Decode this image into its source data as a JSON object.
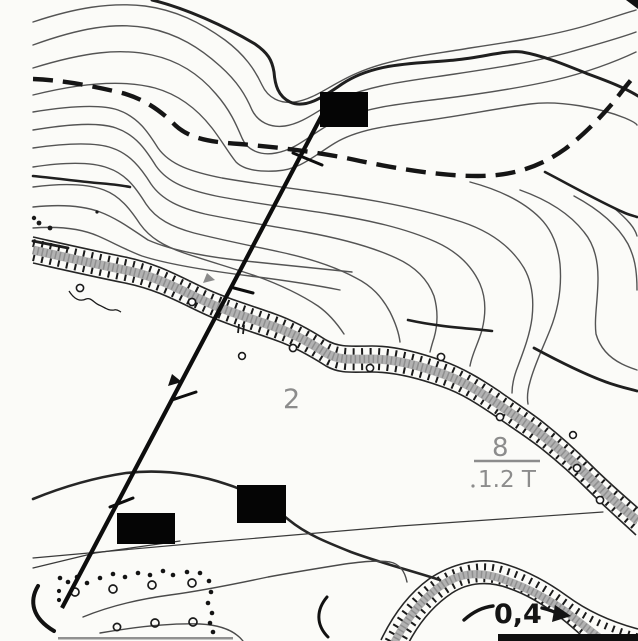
{
  "document": {
    "title": "Scanned topographic map fragment"
  },
  "map": {
    "background_color": "#fbfbf8",
    "ink_color": "#1b1b1b",
    "gray_label_color": "#8c8c8c",
    "stream_fill_color": "#b2b2b2",
    "labels": {
      "gully_depth_marker": "2",
      "crossing_numerator": "8",
      "crossing_denominator": "1.2 T",
      "stream_speed": "0,4"
    },
    "features": [
      {
        "name": "contour-lines"
      },
      {
        "name": "index-contours"
      },
      {
        "name": "dashed-trail"
      },
      {
        "name": "gully-stream-hachured"
      },
      {
        "name": "lower-gully-arc"
      },
      {
        "name": "survey-line-with-ticks"
      },
      {
        "name": "orchard-dotted-area"
      },
      {
        "name": "redaction-box",
        "count": 3
      },
      {
        "name": "flow-direction-arrow"
      }
    ]
  }
}
